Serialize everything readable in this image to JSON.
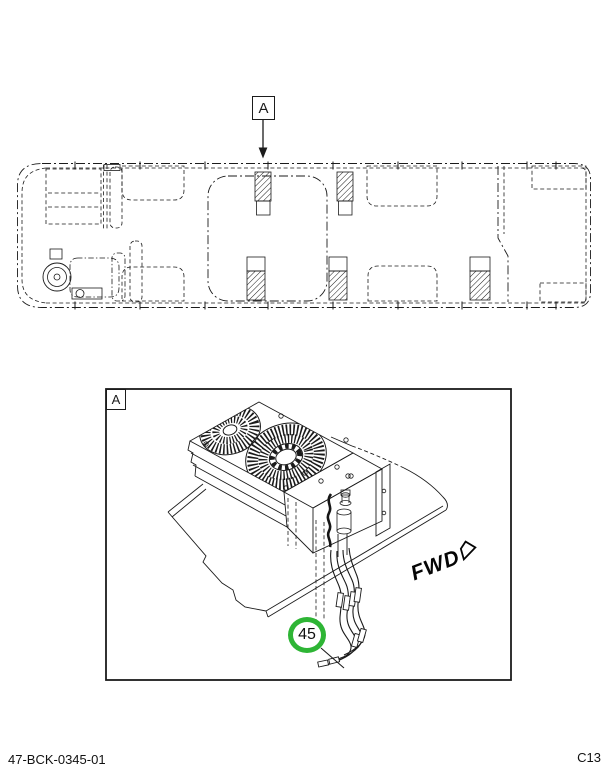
{
  "figure": {
    "overview_callout": "A",
    "detail_label": "A",
    "fwd_label": "FWD",
    "part_number_callout": "45",
    "callout_ring_color": "#2eb535",
    "icons": {
      "overview_arrow": "down-arrow",
      "fwd_arrow": "forward-right-arrow"
    }
  },
  "footer": {
    "left": "47-BCK-0345-01",
    "right": "C13"
  }
}
